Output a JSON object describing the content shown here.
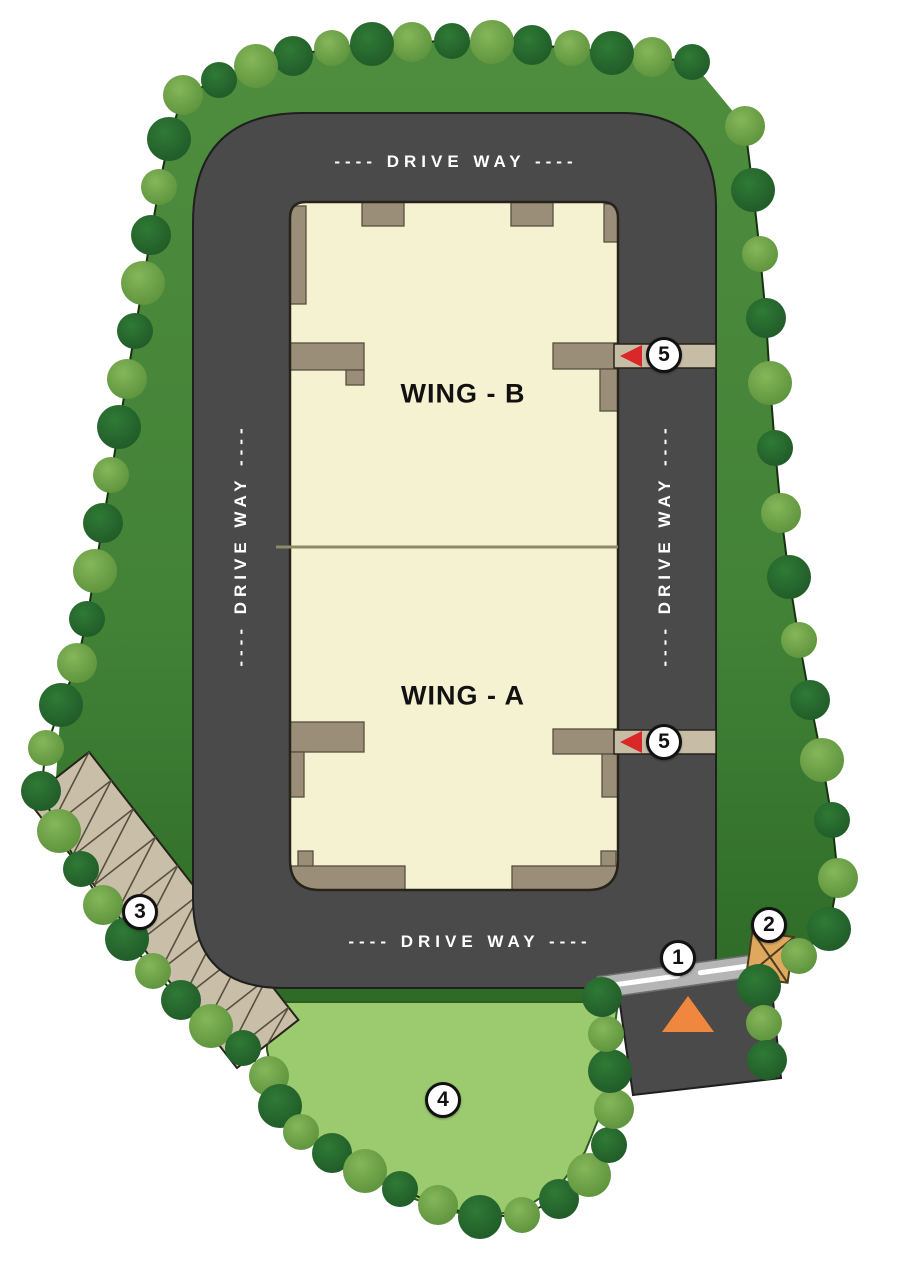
{
  "plan": {
    "driveway_label": "---- DRIVE WAY ----",
    "wing_a_label": "WING - A",
    "wing_b_label": "WING - B"
  },
  "markers": {
    "m1": "1",
    "m2": "2",
    "m3": "3",
    "m4": "4",
    "m5_upper": "5",
    "m5_lower": "5"
  },
  "colors": {
    "site_green_top": "#4f8d3e",
    "site_green_mid": "#428237",
    "site_green_bottom": "#2c6a26",
    "lawn_green": "#9cca6e",
    "lawn_outline": "#2e5e1f",
    "road_gray": "#4a4a4a",
    "road_outline": "#1f1f1f",
    "building_cream": "#f5f2d1",
    "building_outline": "#26231a",
    "shadow_tan": "#9a8e79",
    "strip_tan": "#c7bda7",
    "parking_tan": "#c9bfa8",
    "hatch_brown": "#57503d",
    "divider_olive": "#8b8b6b",
    "tree_dark": "#1e5626",
    "tree_dark_hi": "#2f7a35",
    "tree_light": "#578e38",
    "tree_light_hi": "#85b65a",
    "border_line": "#16320f",
    "marker_red": "#da2828",
    "arrow_orange": "#f0873f",
    "cabin_tan": "#dfa85f",
    "cabin_line": "#4a3b1f",
    "gate_gray": "#b5b5b5",
    "text_white": "#ffffff",
    "text_black": "#111111"
  }
}
